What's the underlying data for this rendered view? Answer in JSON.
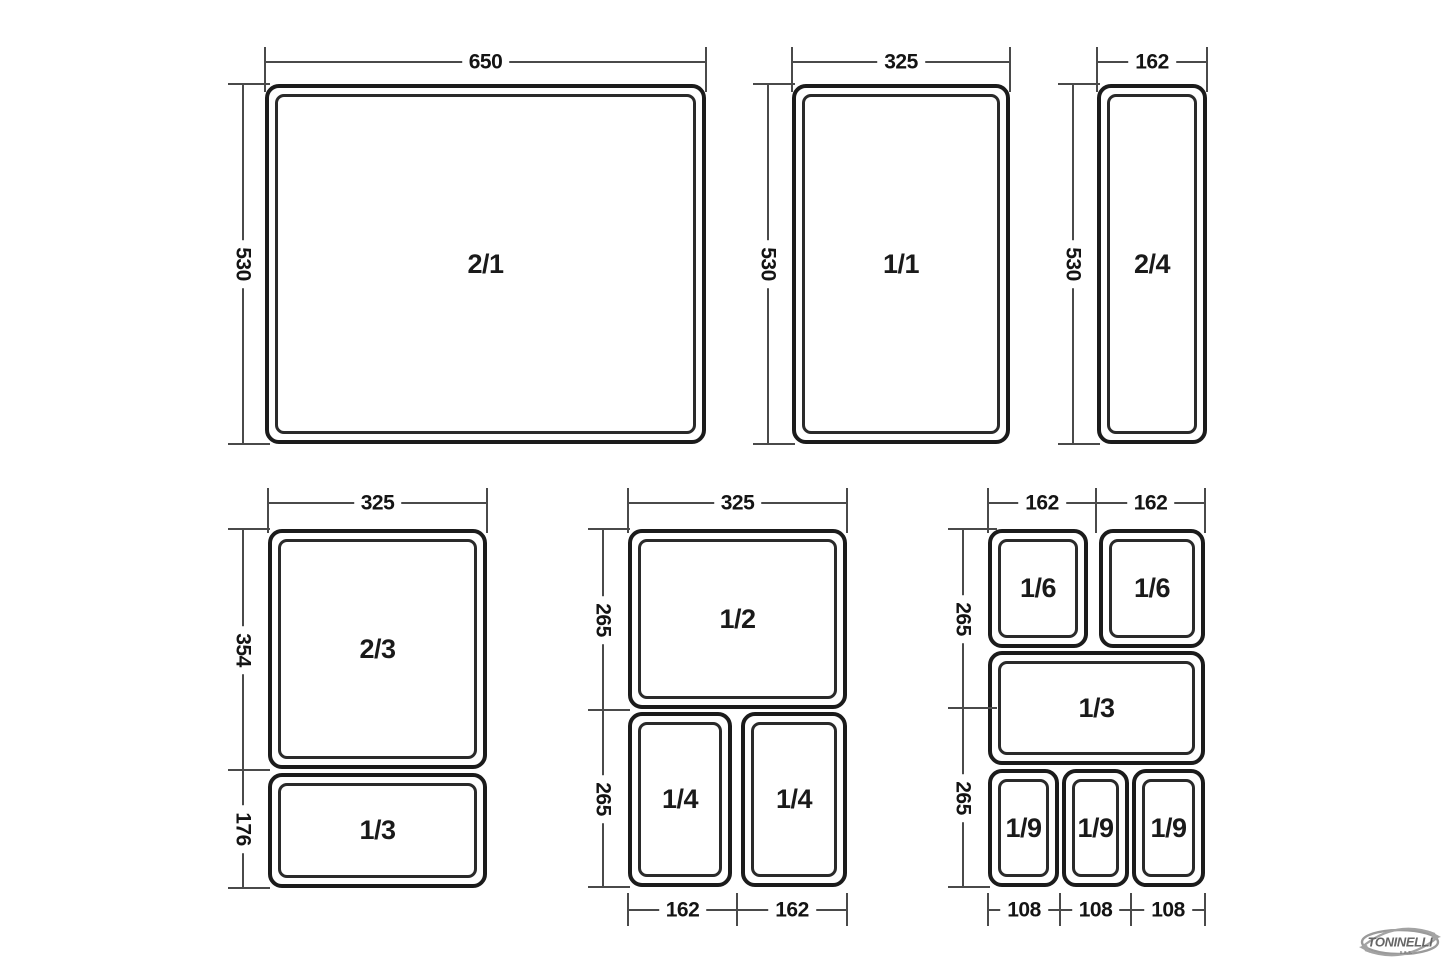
{
  "canvas": {
    "width": 1445,
    "height": 963,
    "background": "#ffffff"
  },
  "style": {
    "box_stroke": "#1b1b1b",
    "inner_stroke": "#2a2a2a",
    "dim_color": "#4a4a4a",
    "text_color": "#141414",
    "logo_gray": "#9a9a9a",
    "logo_text_color": "#666666"
  },
  "logo": {
    "name": "TONINELLI",
    "sub": "s.a.s."
  },
  "panels": [
    {
      "id": "gn-2-1",
      "boxes": [
        {
          "label": "2/1",
          "x": 265,
          "y": 84,
          "w": 441,
          "h": 360
        }
      ],
      "hdims": [
        {
          "label": "650",
          "x1": 265,
          "x2": 706,
          "y": 62,
          "ta": 15,
          "tb": 30
        }
      ],
      "vdims": [
        {
          "label": "530",
          "x": 243,
          "y1": 84,
          "y2": 444,
          "tl": 15,
          "tr": 27
        }
      ]
    },
    {
      "id": "gn-1-1",
      "boxes": [
        {
          "label": "1/1",
          "x": 792,
          "y": 84,
          "w": 218,
          "h": 360
        }
      ],
      "hdims": [
        {
          "label": "325",
          "x1": 792,
          "x2": 1010,
          "y": 62,
          "ta": 15,
          "tb": 30
        }
      ],
      "vdims": [
        {
          "label": "530",
          "x": 768,
          "y1": 84,
          "y2": 444,
          "tl": 15,
          "tr": 27
        }
      ]
    },
    {
      "id": "gn-2-4",
      "boxes": [
        {
          "label": "2/4",
          "x": 1097,
          "y": 84,
          "w": 110,
          "h": 360
        }
      ],
      "hdims": [
        {
          "label": "162",
          "x1": 1097,
          "x2": 1207,
          "y": 62,
          "ta": 15,
          "tb": 30
        }
      ],
      "vdims": [
        {
          "label": "530",
          "x": 1073,
          "y1": 84,
          "y2": 444,
          "tl": 15,
          "tr": 27
        }
      ]
    },
    {
      "id": "gn-2-3-1-3",
      "boxes": [
        {
          "label": "2/3",
          "x": 268,
          "y": 529,
          "w": 219,
          "h": 240
        },
        {
          "label": "1/3",
          "x": 268,
          "y": 773,
          "w": 219,
          "h": 115
        }
      ],
      "hdims": [
        {
          "label": "325",
          "x1": 268,
          "x2": 487,
          "y": 503,
          "ta": 15,
          "tb": 30
        }
      ],
      "vdims": [
        {
          "label": "354",
          "x": 243,
          "y1": 529,
          "y2": 770,
          "tl": 15,
          "tr": 27
        },
        {
          "label": "176",
          "x": 243,
          "y1": 770,
          "y2": 888,
          "tl": 15,
          "tr": 27
        }
      ]
    },
    {
      "id": "gn-1-2-1-4",
      "boxes": [
        {
          "label": "1/2",
          "x": 628,
          "y": 529,
          "w": 219,
          "h": 180
        },
        {
          "label": "1/4",
          "x": 628,
          "y": 712,
          "w": 104,
          "h": 175
        },
        {
          "label": "1/4",
          "x": 741,
          "y": 712,
          "w": 106,
          "h": 175
        }
      ],
      "hdims": [
        {
          "label": "325",
          "x1": 628,
          "x2": 847,
          "y": 503,
          "ta": 15,
          "tb": 30
        },
        {
          "label": "162",
          "x1": 628,
          "x2": 737,
          "y": 910,
          "ta": 17,
          "tb": 16
        },
        {
          "label": "162",
          "x1": 737,
          "x2": 847,
          "y": 910,
          "ta": 17,
          "tb": 16
        }
      ],
      "vdims": [
        {
          "label": "265",
          "x": 603,
          "y1": 529,
          "y2": 710,
          "tl": 15,
          "tr": 27
        },
        {
          "label": "265",
          "x": 603,
          "y1": 710,
          "y2": 887,
          "tl": 15,
          "tr": 27
        }
      ]
    },
    {
      "id": "gn-1-6-1-3-1-9",
      "boxes": [
        {
          "label": "1/6",
          "x": 988,
          "y": 529,
          "w": 100,
          "h": 119
        },
        {
          "label": "1/6",
          "x": 1099,
          "y": 529,
          "w": 106,
          "h": 119
        },
        {
          "label": "1/3",
          "x": 988,
          "y": 651,
          "w": 217,
          "h": 114
        },
        {
          "label": "1/9",
          "x": 988,
          "y": 769,
          "w": 71,
          "h": 118
        },
        {
          "label": "1/9",
          "x": 1062,
          "y": 769,
          "w": 67,
          "h": 118
        },
        {
          "label": "1/9",
          "x": 1132,
          "y": 769,
          "w": 73,
          "h": 118
        }
      ],
      "hdims": [
        {
          "label": "162",
          "x1": 988,
          "x2": 1096,
          "y": 503,
          "ta": 15,
          "tb": 30
        },
        {
          "label": "162",
          "x1": 1096,
          "x2": 1205,
          "y": 503,
          "ta": 15,
          "tb": 30
        },
        {
          "label": "108",
          "x1": 988,
          "x2": 1060,
          "y": 910,
          "ta": 17,
          "tb": 16
        },
        {
          "label": "108",
          "x1": 1060,
          "x2": 1131,
          "y": 910,
          "ta": 17,
          "tb": 16
        },
        {
          "label": "108",
          "x1": 1131,
          "x2": 1205,
          "y": 910,
          "ta": 17,
          "tb": 16
        }
      ],
      "vdims": [
        {
          "label": "265",
          "x": 963,
          "y1": 529,
          "y2": 708,
          "tl": 15,
          "tr": 34
        },
        {
          "label": "265",
          "x": 963,
          "y1": 708,
          "y2": 887,
          "tl": 15,
          "tr": 27
        }
      ]
    }
  ]
}
